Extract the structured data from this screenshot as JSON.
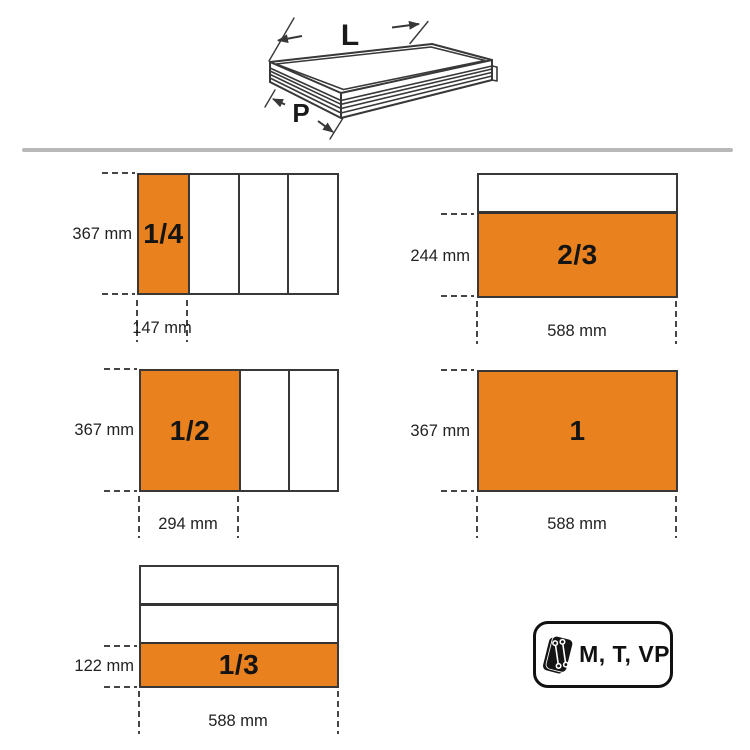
{
  "drawer_illustration": {
    "length_label": "L",
    "depth_label": "P"
  },
  "layouts": [
    {
      "id": "quarter-width-tray",
      "fraction_label": "1/4",
      "height_label": "367 mm",
      "width_label": "147 mm",
      "compartments": 4,
      "orientation": "columns",
      "highlighted_index": 0
    },
    {
      "id": "two-thirds-depth-tray",
      "fraction_label": "2/3",
      "height_label": "244 mm",
      "width_label": "588 mm",
      "compartments": 2,
      "orientation": "rows",
      "highlighted_index": 1
    },
    {
      "id": "half-width-tray",
      "fraction_label": "1/2",
      "height_label": "367 mm",
      "width_label": "294 mm",
      "compartments": 3,
      "orientation": "columns",
      "highlighted_index": 0
    },
    {
      "id": "full-width-tray",
      "fraction_label": "1",
      "height_label": "367 mm",
      "width_label": "588 mm",
      "compartments": 1,
      "orientation": "single",
      "highlighted_index": 0
    },
    {
      "id": "one-third-depth-tray",
      "fraction_label": "1/3",
      "height_label": "122 mm",
      "width_label": "588 mm",
      "compartments": 3,
      "orientation": "rows",
      "highlighted_index": 2
    }
  ],
  "badge": {
    "label": "M, T, VP",
    "icon": "tool-tray-wrenches-icon"
  },
  "colors": {
    "accent_orange": "#E8811E",
    "outline_dark": "#383838",
    "divider_gray": "#B8B8B8",
    "badge_black": "#111111"
  }
}
